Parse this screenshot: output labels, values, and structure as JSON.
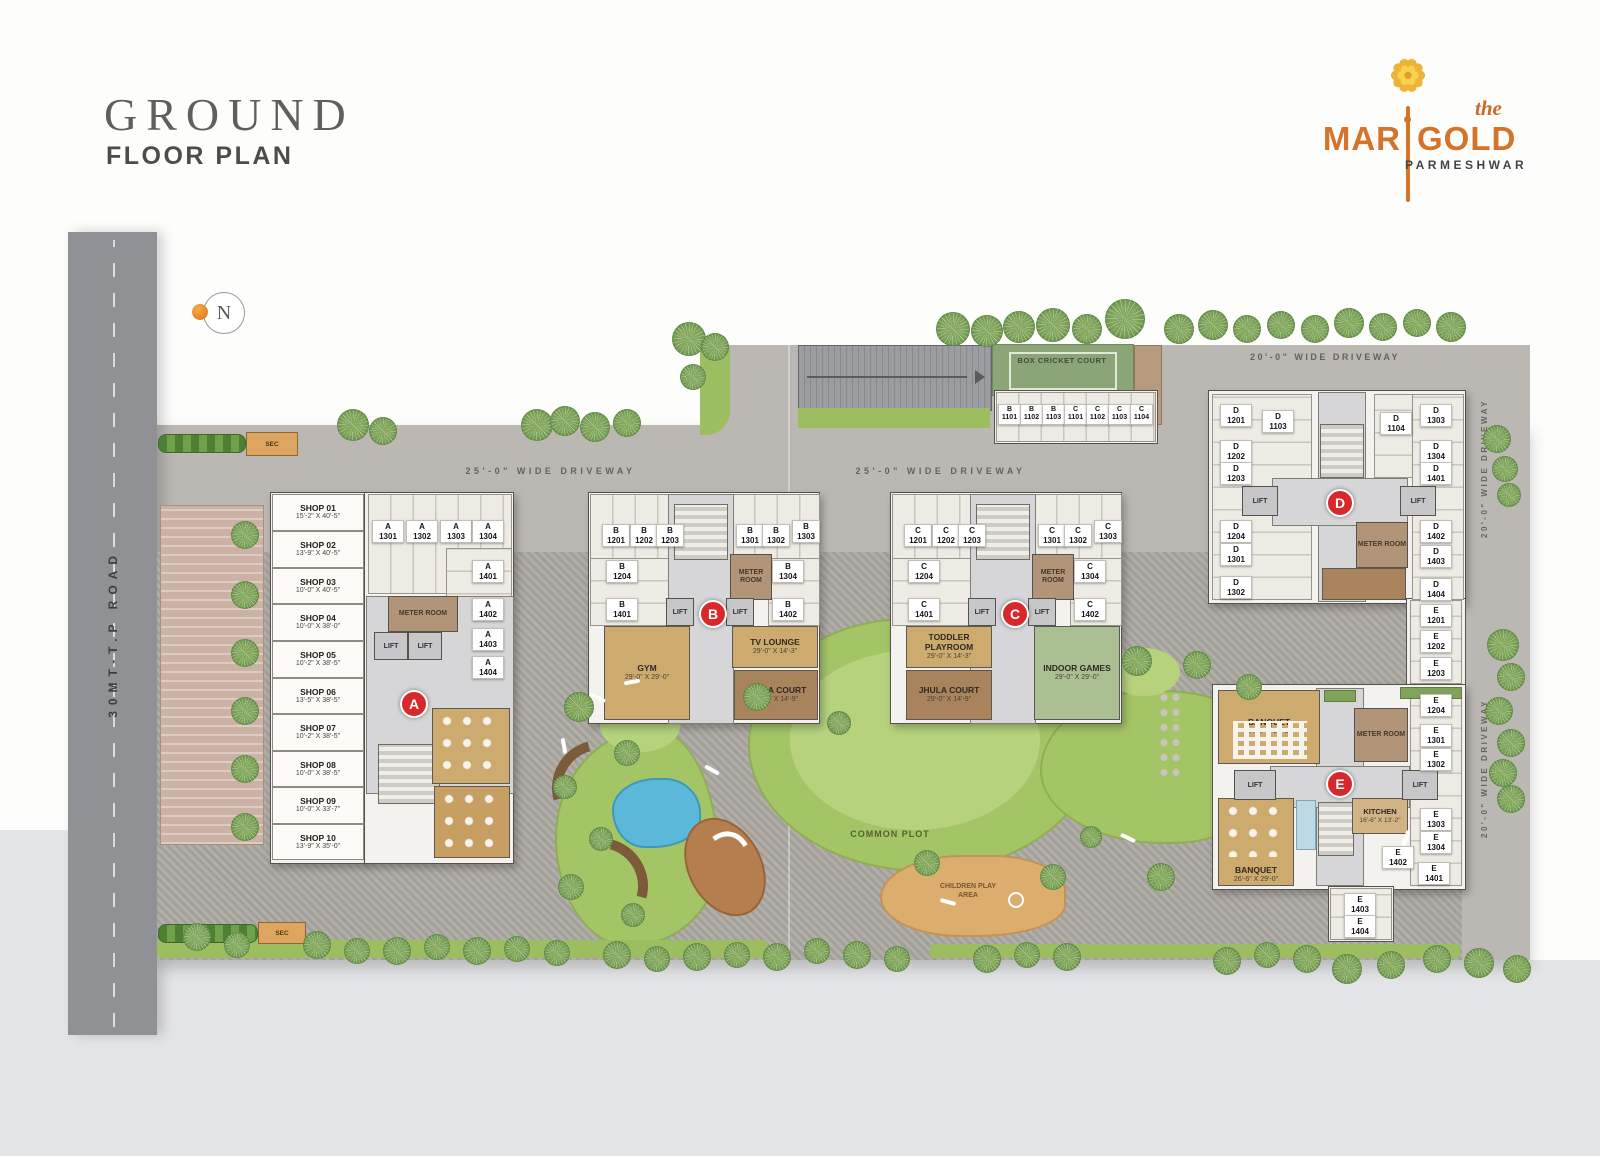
{
  "header": {
    "title_main": "GROUND",
    "title_sub": "FLOOR PLAN"
  },
  "brand": {
    "prefix": "the",
    "name_left": "MAR",
    "name_right": "GOLD",
    "tagline": "PARMESHWAR"
  },
  "compass": {
    "letter": "N"
  },
  "labels": {
    "road": "30MT-T.P ROAD",
    "sec": "SEC",
    "driveway_25": "25'-0\" WIDE DRIVEWAY",
    "driveway_20": "20'-0\" WIDE DRIVEWAY",
    "box_cricket": "BOX CRICKET COURT",
    "common_plot": "COMMON PLOT",
    "children_play": "CHILDREN PLAY AREA",
    "meter_room": "METER ROOM",
    "lift": "LIFT"
  },
  "markers": {
    "a": "A",
    "b": "B",
    "c": "C",
    "d": "D",
    "e": "E"
  },
  "shops": [
    {
      "n": "SHOP 01",
      "d": "15'-2\" X 40'-5\""
    },
    {
      "n": "SHOP 02",
      "d": "13'-9\" X 40'-5\""
    },
    {
      "n": "SHOP 03",
      "d": "10'-0\" X 40'-5\""
    },
    {
      "n": "SHOP 04",
      "d": "10'-0\" X 38'-0\""
    },
    {
      "n": "SHOP 05",
      "d": "10'-2\" X 38'-5\""
    },
    {
      "n": "SHOP 06",
      "d": "13'-5\" X 38'-5\""
    },
    {
      "n": "SHOP 07",
      "d": "10'-2\" X 38'-5\""
    },
    {
      "n": "SHOP 08",
      "d": "10'-0\" X 38'-5\""
    },
    {
      "n": "SHOP 09",
      "d": "10'-0\" X 33'-7\""
    },
    {
      "n": "SHOP 10",
      "d": "13'-9\" X 35'-0\""
    }
  ],
  "rooms": {
    "gym": {
      "n": "GYM",
      "d": "29'-0\" X 29'-0\""
    },
    "tv_lounge": {
      "n": "TV LOUNGE",
      "d": "29'-0\" X 14'-3\""
    },
    "jhula_b": {
      "n": "JHULA COURT",
      "d": "29'-0\" X 14'-9\""
    },
    "toddler": {
      "n": "TODDLER PLAYROOM",
      "d": "29'-0\" X 14'-3\""
    },
    "jhula_c": {
      "n": "JHULA COURT",
      "d": "29'-0\" X 14'-9\""
    },
    "indoor_games": {
      "n": "INDOOR GAMES",
      "d": "29'-0\" X 29'-0\""
    },
    "banquet_1": {
      "n": "BANQUET",
      "d": "34'-0\" X 25'-9\""
    },
    "banquet_2": {
      "n": "BANQUET",
      "d": "26'-6\" X 29'-0\""
    },
    "kitchen": {
      "n": "KITCHEN",
      "d": "16'-6\" X 13'-2\""
    }
  },
  "parking": {
    "row_bc": [
      "B\n1101",
      "B\n1102",
      "B\n1103",
      "C\n1101",
      "C\n1102",
      "C\n1103",
      "C\n1104"
    ],
    "a": [
      "A\n1301",
      "A\n1302",
      "A\n1303",
      "A\n1304",
      "A\n1401",
      "A\n1402",
      "A\n1403",
      "A\n1404"
    ],
    "b": [
      "B\n1201",
      "B\n1202",
      "B\n1203",
      "B\n1301",
      "B\n1302",
      "B\n1303",
      "B\n1204",
      "B\n1401",
      "B\n1304",
      "B\n1402"
    ],
    "c": [
      "C\n1201",
      "C\n1202",
      "C\n1203",
      "C\n1301",
      "C\n1302",
      "C\n1303",
      "C\n1204",
      "C\n1401",
      "C\n1304",
      "C\n1402"
    ],
    "d": [
      "D\n1201",
      "D\n1103",
      "D\n1202",
      "D\n1203",
      "D\n1104",
      "D\n1303",
      "D\n1304",
      "D\n1401",
      "D\n1204",
      "D\n1301",
      "D\n1302",
      "D\n1402",
      "D\n1403",
      "D\n1404"
    ],
    "e": [
      "E\n1201",
      "E\n1202",
      "E\n1203",
      "E\n1204",
      "E\n1301",
      "E\n1302",
      "E\n1303",
      "E\n1304",
      "E\n1401",
      "E\n1402",
      "E\n1403",
      "E\n1404"
    ]
  },
  "colors": {
    "accent_red": "#d8282c",
    "brand_orange": "#d4732a",
    "lawn_green": "#a4c566",
    "pool_blue": "#5cb8d8"
  }
}
